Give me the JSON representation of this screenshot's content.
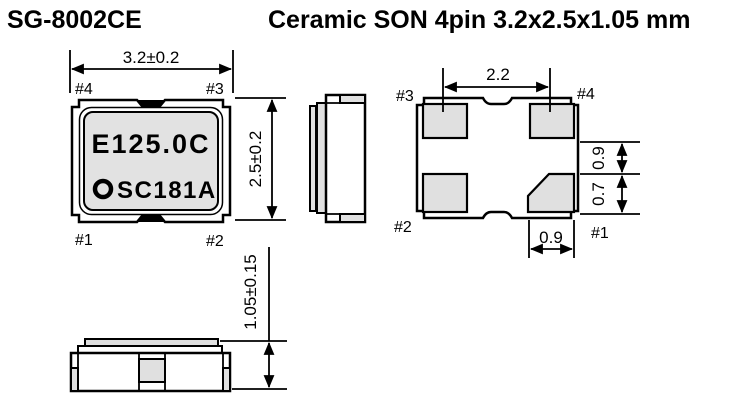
{
  "header": {
    "part_number": "SG-8002CE",
    "package_title": "Ceramic SON 4pin 3.2x2.5x1.05 mm"
  },
  "top_view": {
    "dim_width": "3.2±0.2",
    "dim_height": "2.5±0.2",
    "pin_top_left": "#4",
    "pin_top_right": "#3",
    "pin_bottom_left": "#1",
    "pin_bottom_right": "#2",
    "marking_line1": "E125.0C",
    "marking_line2": "SC181A"
  },
  "bottom_view": {
    "dim_pad_pitch": "2.2",
    "dim_right_upper": "0.9",
    "dim_right_lower": "0.7",
    "dim_pad_width": "0.9",
    "pin_top_left": "#3",
    "pin_top_right": "#4",
    "pin_bottom_left": "#2",
    "pin_bottom_right": "#1"
  },
  "front_view": {
    "dim_thickness": "1.05±0.15"
  },
  "colors": {
    "line": "#000000",
    "pad_fill": "#e0e0e0",
    "marking_fill": "#e2e2e2",
    "background": "#ffffff"
  }
}
